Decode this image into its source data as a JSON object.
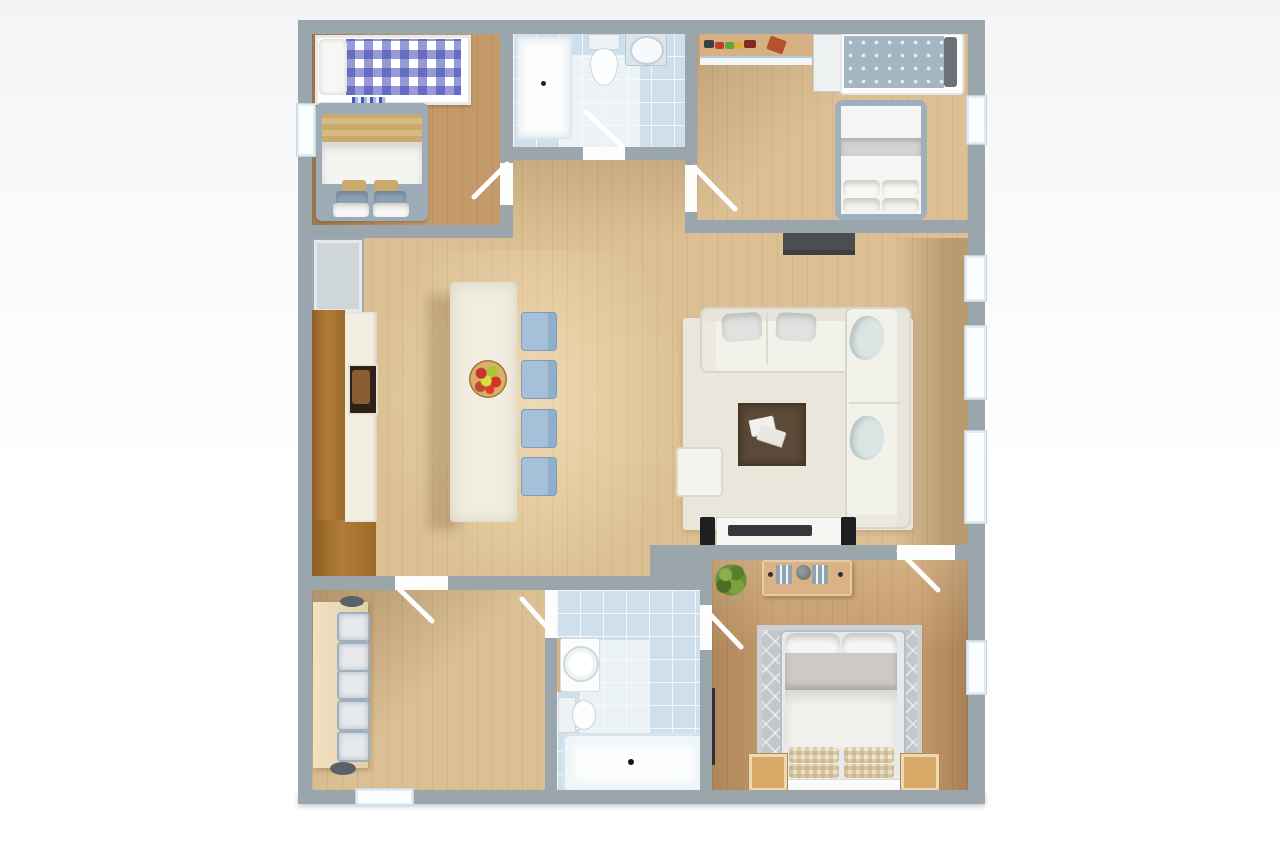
{
  "scene": {
    "type": "3d-floor-plan-render",
    "view": "top-down",
    "visible_text": "none",
    "palette": {
      "page_background": "#f6f8f9",
      "wall": "#9aa5ac",
      "wood_floor_light": "#dcc094",
      "wood_floor_dark": "#c49a6b",
      "bathroom_tile": "#cfe0ec",
      "kitchen_cabinet_wood": "#a9742f",
      "island_counter": "#f1ede0",
      "chair_blue": "#a6c0da",
      "sofa_white": "#f2f1ea",
      "rug_living": "#e9e6db",
      "rug_bedroom_gray": "#c3c6ca",
      "coffee_table_brown": "#5c4938",
      "tv_dark": "#35383b",
      "speaker_black": "#1d1f21",
      "bed_gingham_blue": "#3f46b4",
      "bed_polka_gray_blue": "#a4b6c2",
      "blanket_tan": "#c9a96d",
      "nightstand_wood": "#d8a866",
      "plant_green": "#6a8f35",
      "window_glass": "#fbfdff"
    },
    "rooms": [
      {
        "name": "bedroom-top-left",
        "furniture": [
          "single-bed-gingham",
          "double-bed-tan-blanket",
          "striped-mat"
        ],
        "windows": [
          "left-wall"
        ]
      },
      {
        "name": "bathroom-top",
        "furniture": [
          "shower-tray",
          "toilet",
          "sink-vanity"
        ],
        "doors": [
          "south"
        ]
      },
      {
        "name": "bedroom-top-right",
        "furniture": [
          "toy-shelf",
          "wardrobe",
          "single-bed-polka",
          "double-bed-white"
        ],
        "windows": [
          "right-wall"
        ]
      },
      {
        "name": "kitchen-dining",
        "furniture": [
          "refrigerator",
          "cabinet-run",
          "counter-with-sink",
          "island-table",
          "fruit-bowl",
          "dining-chairs-x4"
        ]
      },
      {
        "name": "living-room",
        "furniture": [
          "l-shaped-sofa",
          "coffee-table",
          "ottoman",
          "area-rug",
          "tv-console",
          "speakers-x2",
          "wall-console-dark"
        ],
        "windows": [
          "right-wall-x3"
        ]
      },
      {
        "name": "office-bottom-left",
        "furniture": [
          "work-table",
          "upholstered-stools-x5"
        ],
        "windows": [
          "bottom-wall"
        ]
      },
      {
        "name": "bathroom-bottom",
        "furniture": [
          "sink-vanity",
          "toilet",
          "bathtub"
        ],
        "doors": [
          "west",
          "east"
        ]
      },
      {
        "name": "bedroom-bottom-right",
        "furniture": [
          "desk-with-books",
          "plant",
          "double-bed-checkered-pillows",
          "nightstands-x2",
          "patterned-rug",
          "wall-tv"
        ],
        "windows": [
          "right-wall"
        ]
      }
    ],
    "counts": {
      "dining_chairs": 4,
      "stool_cushions": 5,
      "door_leaves": 7,
      "window_segments": 7
    }
  }
}
